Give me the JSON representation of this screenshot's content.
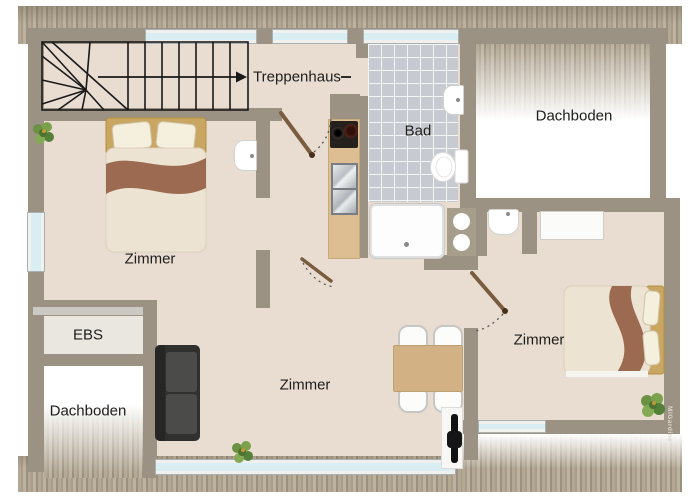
{
  "labels": {
    "staircase": "Treppenhaus",
    "bathroom": "Bad",
    "attic_top_right": "Dachboden",
    "attic_bottom_left": "Dachboden",
    "bedroom_left": "Zimmer",
    "living_room": "Zimmer",
    "bedroom_right": "Zimmer",
    "built_in_closet": "EBS"
  },
  "watermark": "MiGardine",
  "palette": {
    "wall": "#9c9283",
    "floor": "#e9ddd2",
    "attic_floor": "#ffffff",
    "tile": "#c7cbd1",
    "window_glass": "#d9eef3",
    "stair_line": "#1a1a1a",
    "bed_accent_brown": "#9c6a50",
    "headboard_gold": "#c9a662",
    "sofa": "#3a3a38",
    "table_wood": "#d2b285",
    "plant_green": "#6a9242",
    "door_wood": "#7a5c3e"
  }
}
